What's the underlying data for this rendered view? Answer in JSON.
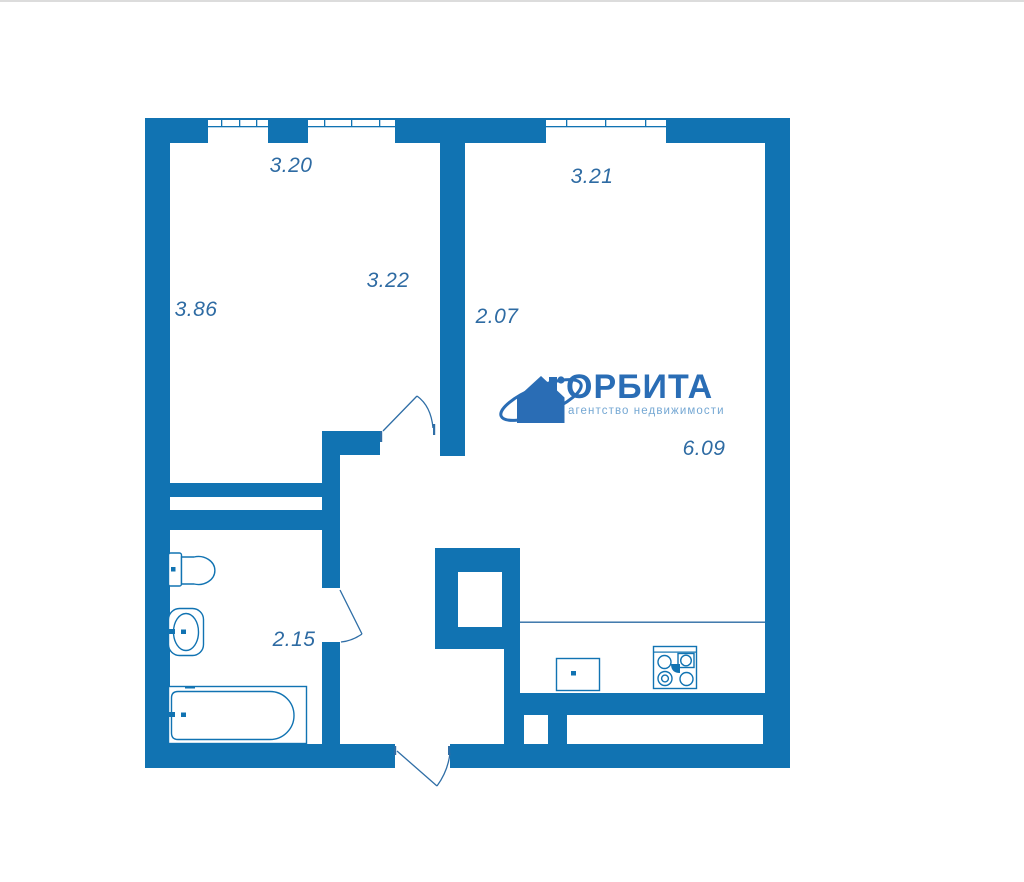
{
  "plan": {
    "colors": {
      "wall": "#1173b2",
      "door_line": "#2f6ea6",
      "dimension_text": "#2e6ba3"
    },
    "dimensions": {
      "living_room_width_top": "3.20",
      "living_room_height_left": "3.86",
      "living_room_inner": "3.22",
      "kitchen_living_width_top": "3.21",
      "kitchen_living_height_left": "2.07",
      "kitchen_living_inner": "6.09",
      "bathroom_width": "2.15"
    },
    "fixtures": [
      "toilet",
      "bathroom-sink",
      "bathtub",
      "kitchen-sink",
      "stove"
    ]
  },
  "logo": {
    "name": "ОРБИТА",
    "tagline": "агентство недвижимости",
    "brand_color": "#2a6db5",
    "tagline_color": "#74a7d3",
    "icon": "house-orbit-icon"
  }
}
